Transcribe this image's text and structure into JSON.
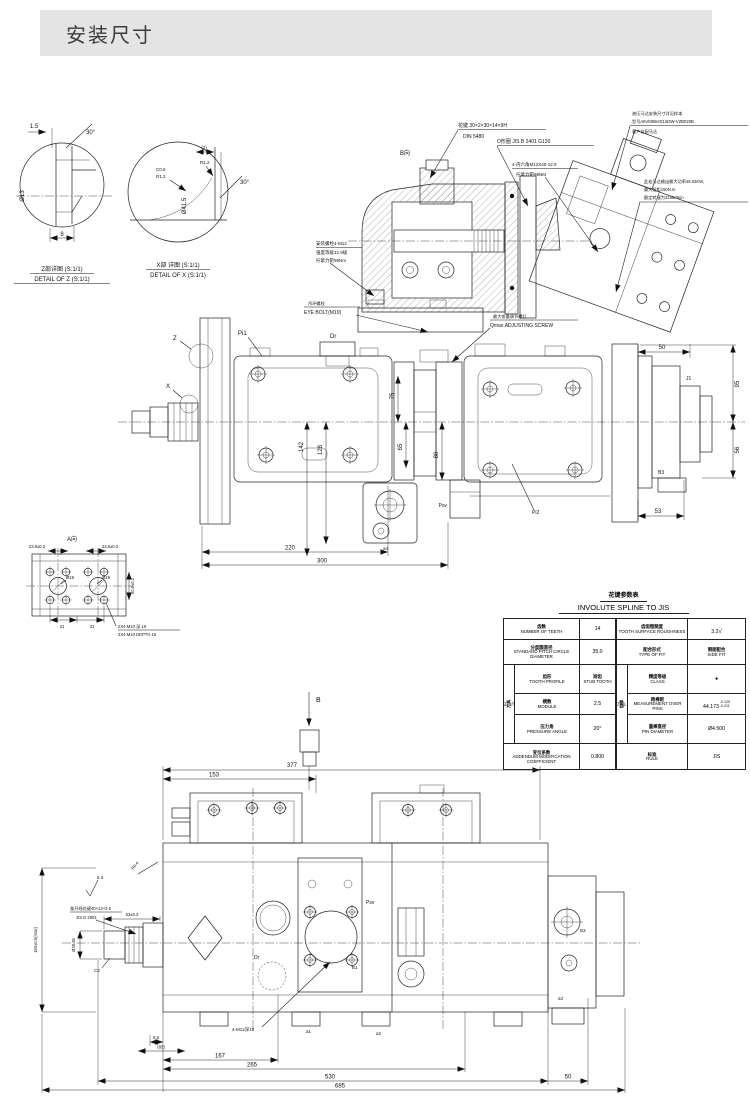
{
  "header": {
    "title": "安装尺寸"
  },
  "detail_z": {
    "title_cn": "Z部详图 (S:1/1)",
    "title_en": "DETAIL OF Z (S:1/1)",
    "dim_width": "1.5",
    "dim_angle": "30°",
    "dim_depth": "8",
    "dim_bore": "Ø13"
  },
  "detail_x": {
    "title_cn": "X部 详图 (S:1/1)",
    "title_en": "DETAIL OF X (S:1/1)",
    "dim_groove": "(2)",
    "dim_r_top": "R1.2",
    "dim_chamfer": "C0.5",
    "dim_r_bottom": "R1.2",
    "dim_angle": "30°",
    "dim_bore": "Ø41.5"
  },
  "section_view": {
    "view_label": "B向",
    "spline_note_1": "花键 30×2×30×14×9H",
    "spline_note_2": "DIN 5480",
    "oring_note": "O形圈 JIS B 2401 G130",
    "socket_bolt_1": "4-内六角M12X40-12.9",
    "socket_bolt_2": "拧紧力矩98NM",
    "motor_note_1": "液压马达安装尺寸详见样本",
    "motor_note_2": "型号A6VM55HD1/63W-VZB020B",
    "motor_note_3": "客户自配马达",
    "power_note_1": "此处马达输出最大功率46.03KW,",
    "power_note_2": "最大扭矩150N.m",
    "power_note_3": "额定转速为2150r/min",
    "mount_bolt_1": "安装螺栓4-M12",
    "mount_bolt_2": "强度等级12.9级",
    "mount_bolt_3": "拧紧力矩98Nm",
    "eye_bolt_cn": "吊环螺栓",
    "eye_bolt_en": "EYE BOLT(M10)",
    "qmax_cn": "最大排量调节螺钉",
    "qmax_en": "Qmax.ADJUSTING SCREW"
  },
  "side_view": {
    "label_z": "Z",
    "label_x": "X",
    "label_dr": "Dr",
    "label_pi1": "Pi1",
    "label_pi2": "Pi2",
    "label_psv": "Psv",
    "label_b3": "B3",
    "label_j1": "J1",
    "label_a4": "a4",
    "dim_142": "142",
    "dim_128": "128",
    "dim_75": "75",
    "dim_65": "65",
    "dim_80": "80",
    "dim_220": "220",
    "dim_300": "300",
    "dim_50": "50",
    "dim_95": "95",
    "dim_56": "56",
    "dim_53": "53"
  },
  "view_a": {
    "label": "A向",
    "dim_pitch_left": "23.8±0.2",
    "dim_pitch_right": "23.8±0.2",
    "dim_port_left": "Ø19",
    "dim_port_right": "Ø19",
    "dim_vertical": "50.8±0.2",
    "dim_31_left": "31",
    "dim_31_right": "31",
    "thread_note_cn": "2X4-M10 深 16",
    "thread_note_en": "2X4-M10 DEPTH 16"
  },
  "spline_table": {
    "title_cn": "花键参数表",
    "title_en": "INVOLUTE SPLINE TO JIS",
    "group_cutter_cn": "刀具",
    "group_cutter_en": "CUTTER",
    "group_thickness_cn": "齿厚",
    "group_thickness_en": "TOOTH THICKNESS",
    "left": [
      {
        "cn": "齿数",
        "en": "NUMBER OF TEETH",
        "val": "14"
      },
      {
        "cn": "分度圆直径",
        "en": "STANDARD PITCH CIRCLE DIAMETER",
        "val": "35.0"
      },
      {
        "cn": "齿形",
        "en": "TOOTH PROFILE",
        "val_cn": "短齿",
        "val_en": "STUB TOOTH"
      },
      {
        "cn": "模数",
        "en": "MODULE",
        "val": "2.5"
      },
      {
        "cn": "压力角",
        "en": "PRESSURE ANGLE",
        "val": "20°"
      },
      {
        "cn": "变位系数",
        "en": "ADDENDUM MODIFICATION COEFFICIENT",
        "val": "0.800"
      }
    ],
    "right": [
      {
        "cn": "齿面粗糙度",
        "en": "TOOTH SURFACE ROUGHNESS",
        "val": "3.2"
      },
      {
        "cn": "配合形式",
        "en": "TYPE OF FIT",
        "val_cn": "侧面配合",
        "val_en": "SIDE FIT"
      },
      {
        "cn": "精度等级",
        "en": "CLASS",
        "val": "●"
      },
      {
        "cn": "跨棒距",
        "en": "MEASUREMENT OVER PINS",
        "val": "44.173",
        "tol_upper": "-0.125",
        "tol_lower": "-0.211"
      },
      {
        "cn": "量棒直径",
        "en": "PIN DIAMETER",
        "val": "Ø4.500"
      },
      {
        "cn": "标准",
        "en": "RULE",
        "val": "JIS"
      }
    ]
  },
  "bottom_view": {
    "view_label": "B",
    "dim_377": "377",
    "dim_153": "153",
    "surface_roughness": "6.3",
    "fillet": "R0.4",
    "spline_note_1": "渐开线花键40×14×2.5",
    "spline_note_2": "JIS D 2001",
    "dim_spline_len": "53±0.3",
    "dim_shaft_dia": "Ø39.36",
    "chamfer": "C2",
    "dim_height": "160±0.5(max)",
    "bolt_note": "4-M12深18",
    "label_dr": "Dr",
    "label_psv": "Psv",
    "label_b1": "B1",
    "label_b3": "B3",
    "label_a1": "a1",
    "label_a2": "a2",
    "label_a3": "a3",
    "dim_8_5": "8.5",
    "dim_85": "(85)",
    "dim_167": "167",
    "dim_265": "265",
    "dim_530": "530",
    "dim_685": "685",
    "dim_50": "50"
  }
}
